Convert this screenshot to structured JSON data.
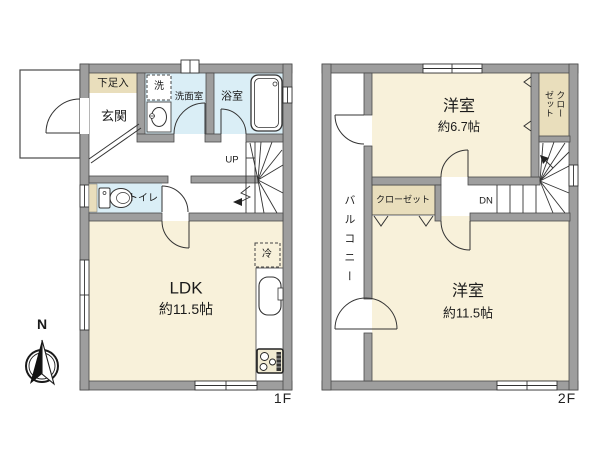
{
  "floor1": {
    "floor_label": "1F",
    "shoe_cabinet": "下足入",
    "entrance": "玄関",
    "washer": "洗",
    "washroom": "洗面室",
    "bathroom": "浴室",
    "toilet": "トイレ",
    "stairs_up": "UP",
    "fridge": "冷",
    "ldk_name": "LDK",
    "ldk_size": "約11.5帖"
  },
  "floor2": {
    "floor_label": "2F",
    "balcony": "バルコニー",
    "room_a_name": "洋室",
    "room_a_size": "約6.7帖",
    "closet_vertical": "クロー\nゼット",
    "closet": "クローゼット",
    "stairs_down": "DN",
    "room_b_name": "洋室",
    "room_b_size": "約11.5帖"
  },
  "compass": {
    "north_label": "N"
  },
  "colors": {
    "wall": "#9e9e9e",
    "wall_outline": "#4a4a4a",
    "room_cream": "#f8f1da",
    "room_wet_blue": "#daeef6",
    "storage_tan": "#e9debc",
    "line": "#333333",
    "background": "#ffffff"
  }
}
